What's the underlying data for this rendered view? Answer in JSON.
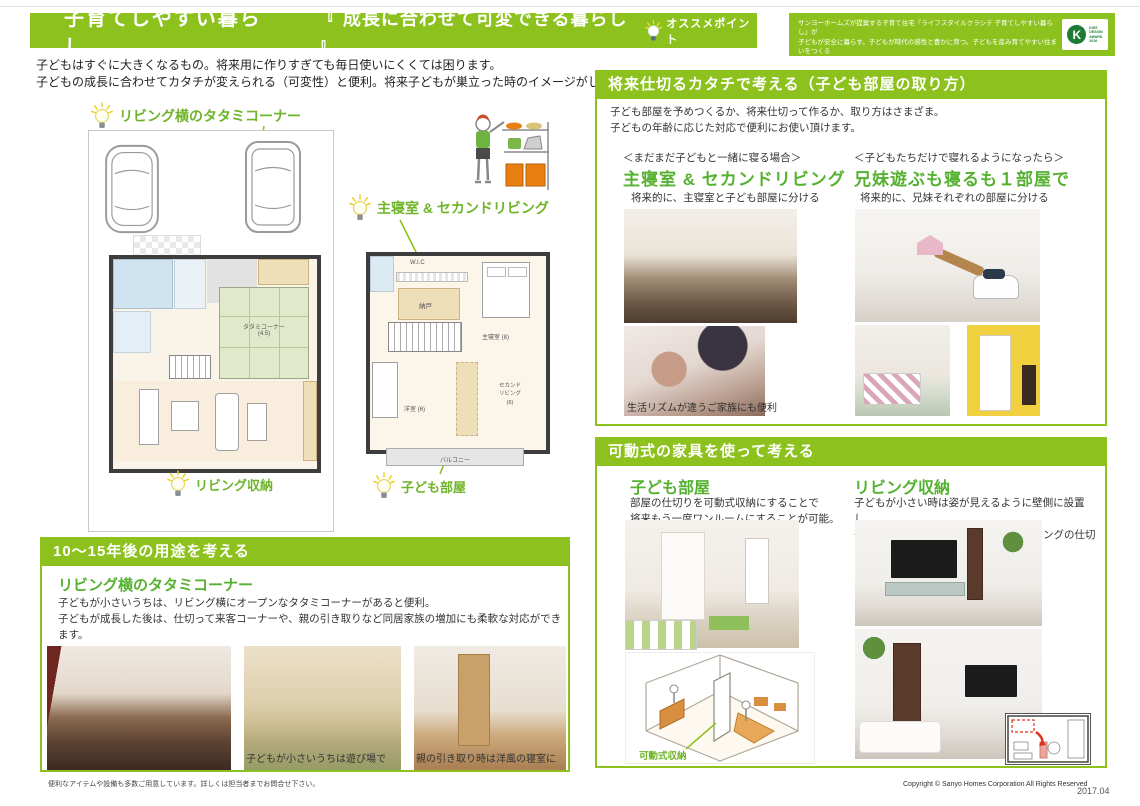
{
  "colors": {
    "bar_green": "#8dc21e",
    "heading_green": "#55b230",
    "wall_dark": "#3d3d3d",
    "tatami_green": "#e0eaca",
    "award_green": "#1c7c33"
  },
  "header": {
    "title": "子育てしやすい暮らし",
    "subtitle": "『 成長に合わせて可変できる暮らし 』",
    "badge": "オススメポイント",
    "award_text_1": "サンヨーホームズが提案する子育て住宅『ライフスタイルクラシテ 子育てしやすい暮らし』が",
    "award_text_2": "子どもが安全に暮らす。子どもが時代の感性と豊かに育つ。子どもを産み育てやすい住まいをつくる",
    "award_text_3": "提案が優れたものとして評価され、2016年キッズデザイン賞を受賞しました。",
    "award_logo_mark": "K",
    "award_logo_lines": [
      "KIDS",
      "DESIGN",
      "AWARD",
      "2016"
    ]
  },
  "intro": {
    "line1": "子どもはすぐに大きくなるもの。将来用に作りすぎても毎日使いにくくては困ります。",
    "line2": "子どもの成長に合わせてカタチが変えられる（可変性）と便利。将来子どもが巣立った時のイメージがしやすくなります。"
  },
  "plans": {
    "label_tatami_corner": "リビング横のタタミコーナー",
    "label_living_storage": "リビング収納",
    "label_master_bedroom": "主寝室 & セカンドリビング",
    "label_kids_room": "子ども部屋",
    "plan1": {
      "tatami": "タタミコーナー",
      "tatami_size": "(4.5)",
      "ldk": "LDK(16)"
    },
    "plan2": {
      "wic": "W.I.C",
      "nando": "納戸",
      "master": "主寝室 (8)",
      "western": "洋室 (6)",
      "second_living_1": "セカンド",
      "second_living_2": "リビング",
      "second_living_3": "(6)",
      "balcony": "バルコニー"
    }
  },
  "section_usage": {
    "header": "10〜15年後の用途を考える",
    "heading": "リビング横のタタミコーナー",
    "body1": "子どもが小さいうちは、リビング横にオープンなタタミコーナーがあると便利。",
    "body2": "子どもが成長した後は、仕切って来客コーナーや、親の引き取りなど同居家族の増加にも柔軟な対応ができます。",
    "caption2": "子どもが小さいうちは遊び場で",
    "caption3": "親の引き取り時は洋風の寝室に"
  },
  "section_partition": {
    "header": "将来仕切るカタチで考える（子ども部屋の取り方）",
    "body1": "子ども部屋を予めつくるか、将来仕切って作るか、取り方はさまざま。",
    "body2": "子どもの年齢に応じた対応で便利にお使い頂けます。",
    "left": {
      "case": "＜まだまだ子どもと一緒に寝る場合＞",
      "title": "主寝室 & セカンドリビング",
      "note": "将来的に、主寝室と子ども部屋に分ける",
      "caption": "生活リズムが違うご家族にも便利"
    },
    "right": {
      "case": "＜子どもたちだけで寝れるようになったら＞",
      "title": "兄妹遊ぶも寝るも１部屋で",
      "note": "将来的に、兄妹それぞれの部屋に分ける"
    }
  },
  "section_furniture": {
    "header": "可動式の家具を使って考える",
    "left": {
      "title": "子ども部屋",
      "body1": "部屋の仕切りを可動式収納にすることで",
      "body2": "将来もう一度ワンルームにすることが可能。",
      "caption": "可動式収納"
    },
    "right": {
      "title": "リビング収納",
      "body1": "子どもが小さい時は姿が見えるように壁側に設置し、",
      "body2": "子どもが大きくなったらリビングダイニングの仕切りにも"
    }
  },
  "footer": {
    "note": "便利なアイテムや設備も多数ご用意しています。詳しくは担当者までお問合せ下さい。",
    "copyright": "Copyright © Sanyo Homes Corporation All Rights Reserved",
    "date": "2017.04"
  }
}
